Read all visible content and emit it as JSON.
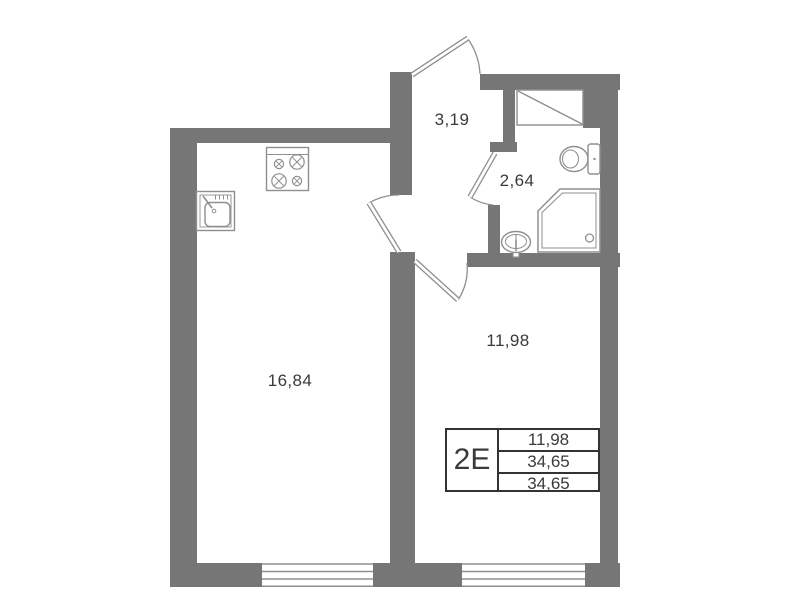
{
  "apartment": {
    "rooms": {
      "living_kitchen": {
        "area": "16,84"
      },
      "room": {
        "area": "11,98"
      },
      "hallway": {
        "area": "3,19"
      },
      "bathroom": {
        "area": "2,64"
      }
    },
    "legend": {
      "type": "2Е",
      "rows": [
        "11,98",
        "34,65",
        "34,65"
      ]
    },
    "fixtures": [
      "stove-icon",
      "kitchen-sink-icon",
      "toilet-icon",
      "shower-icon",
      "washbasin-icon",
      "vent-shaft-icon"
    ],
    "features": [
      "entrance-door",
      "living-room-door",
      "bathroom-door",
      "room-door",
      "window-left",
      "window-right"
    ],
    "colors": {
      "wall": "#767676",
      "fixture_outline": "#8f8f8f",
      "text": "#3a3a3a",
      "legend_border": "#333333",
      "background": "#ffffff"
    }
  }
}
